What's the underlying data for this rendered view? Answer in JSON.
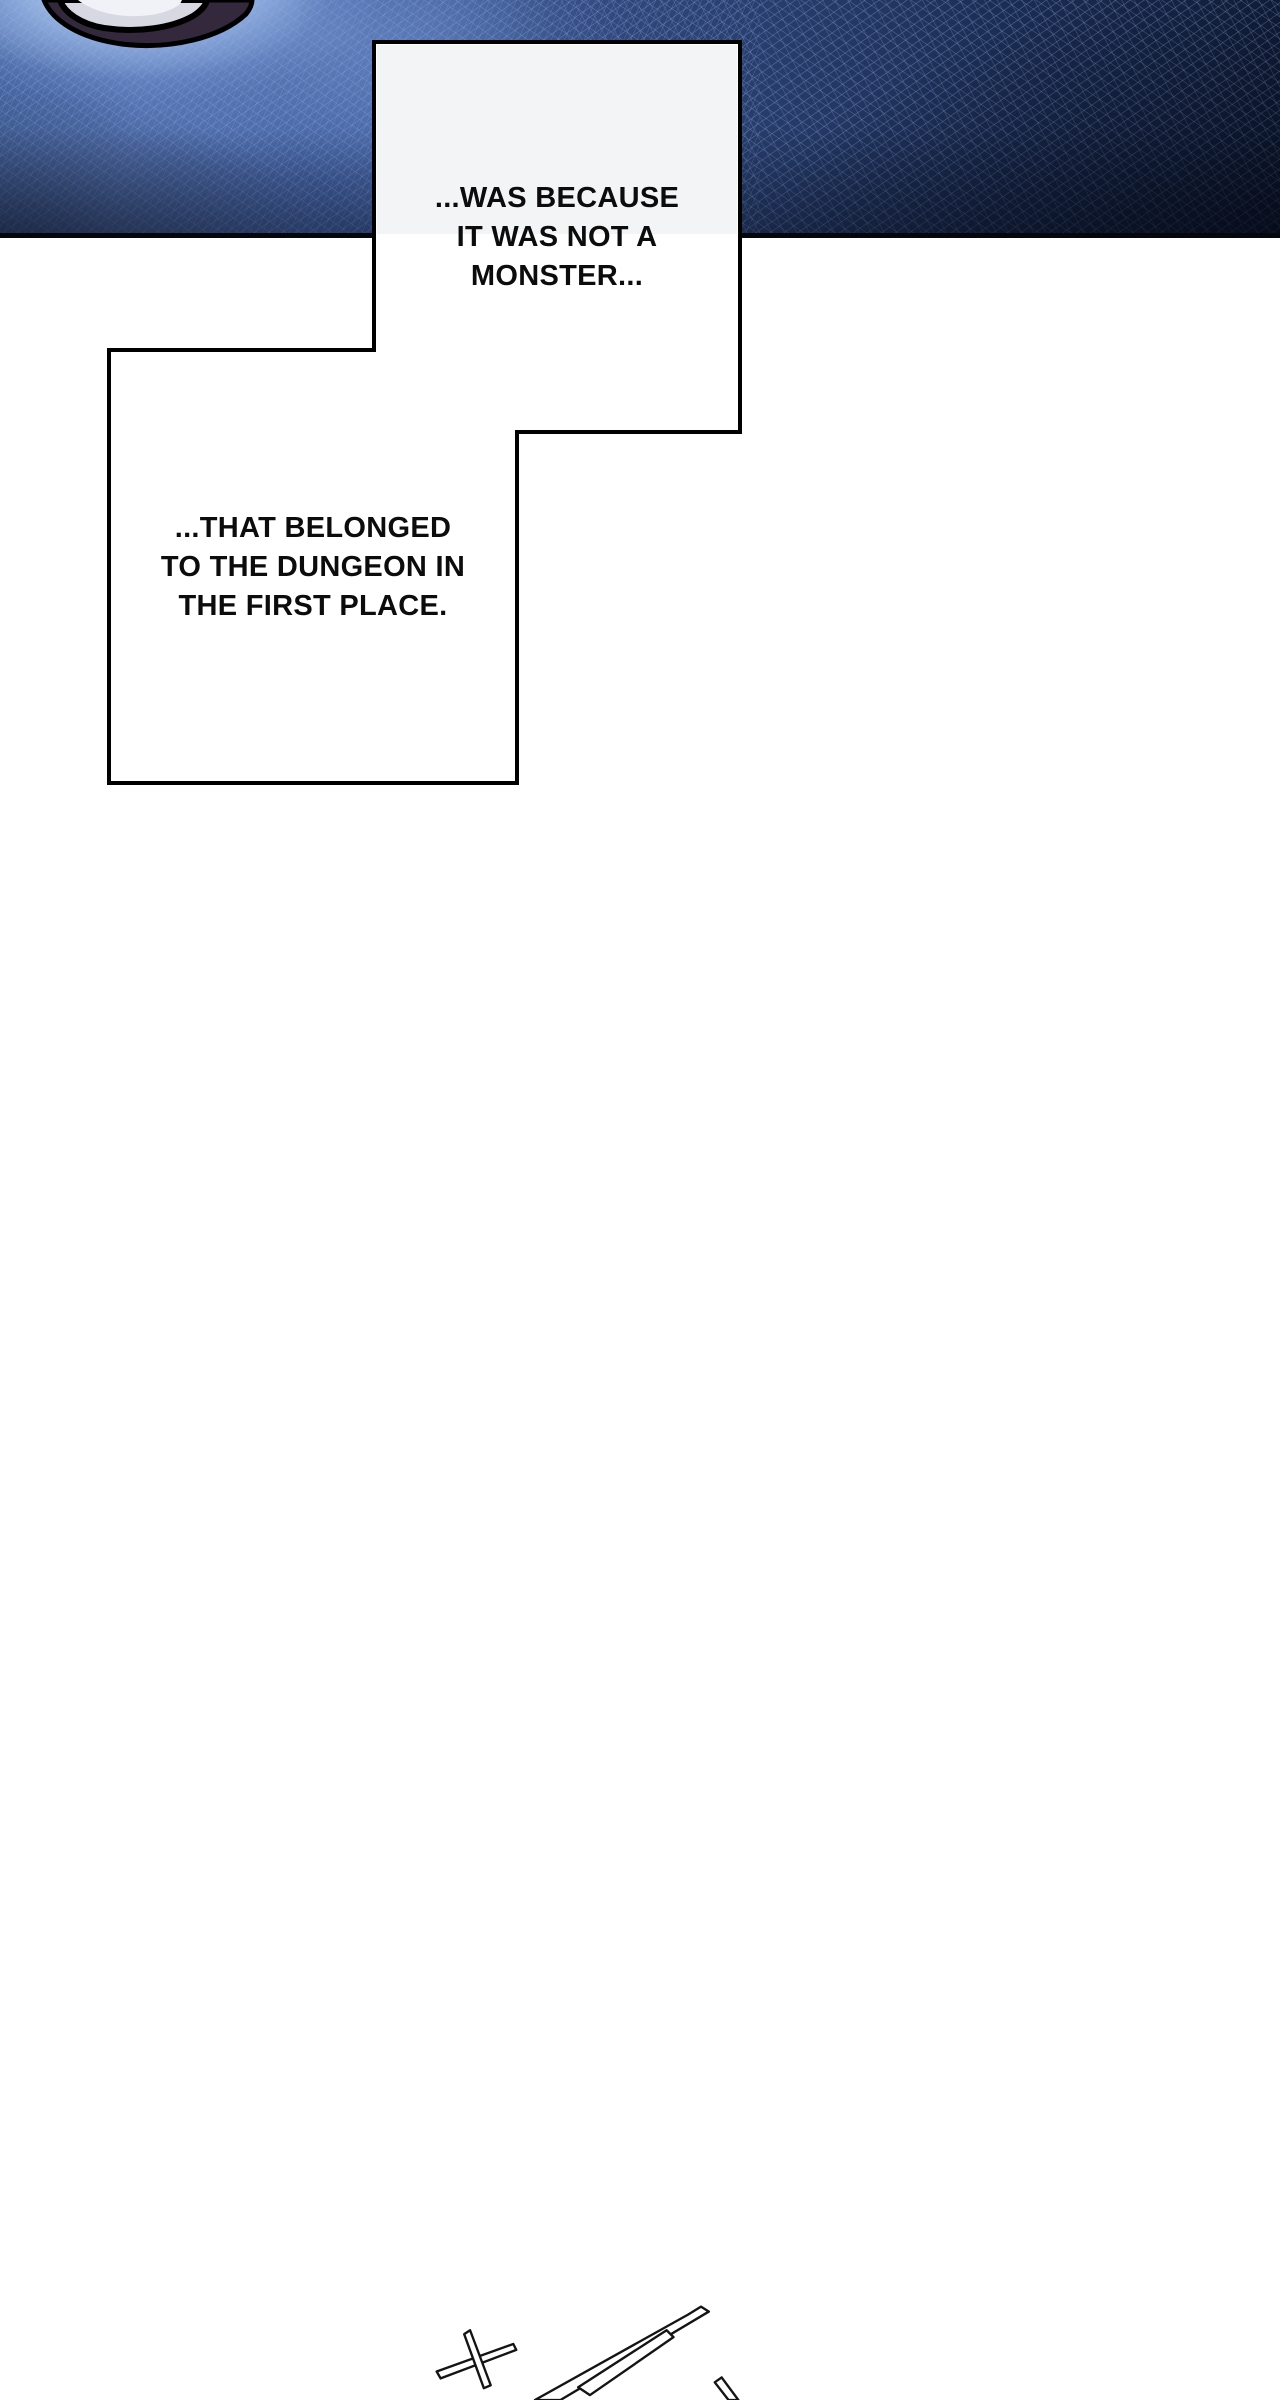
{
  "meta": {
    "kind": "webtoon-comic-page"
  },
  "captions": [
    {
      "name": "caption-1",
      "lines": [
        "...WAS BECAUSE",
        "IT WAS NOT A",
        "MONSTER..."
      ]
    },
    {
      "name": "caption-2",
      "lines": [
        "...THAT BELONGED",
        "TO THE DUNGEON IN",
        "THE FIRST PLACE."
      ]
    }
  ],
  "artwork": {
    "top_panel": "dark-blue-dungeon-ceiling-crosshatch",
    "rock": "glowing-rock-fragment",
    "bottom_sketch": "sword-sketch-line-art-cutoff"
  },
  "colors": {
    "ink": "#0c0c0c",
    "paper": "#ffffff",
    "panel_navy_dark": "#0e1930",
    "panel_navy": "#253a67",
    "panel_blue": "#5271b0",
    "glow_blue": "#cfe0fa",
    "rock_gray": "#d7d8e2",
    "border_black": "#000000"
  }
}
